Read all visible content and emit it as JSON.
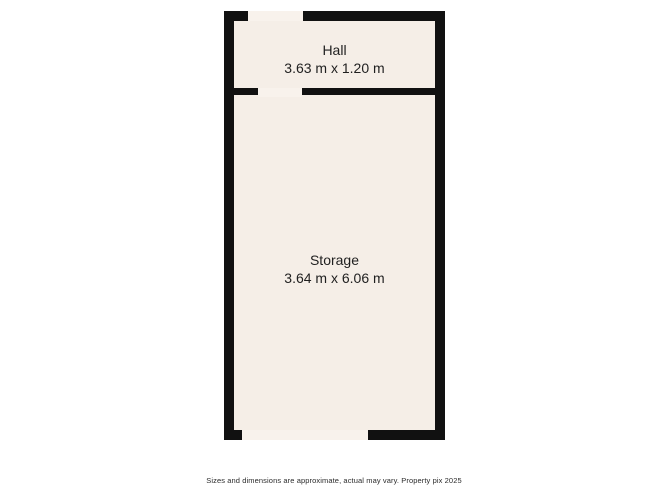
{
  "plan": {
    "rooms": {
      "hall": {
        "name": "Hall",
        "dims": "3.63 m x 1.20 m"
      },
      "storage": {
        "name": "Storage",
        "dims": "3.64 m x 6.06 m"
      }
    }
  },
  "footer": {
    "disclaimer": "Sizes and dimensions are approximate, actual may vary. Property pix 2025"
  },
  "colors": {
    "background": "#ffffff",
    "wall": "#111111",
    "floor": "#f5eee7",
    "threshold": "#f8f2ec",
    "room_text": "#1f1f1f",
    "disclaimer_text": "#2b2b2b"
  }
}
